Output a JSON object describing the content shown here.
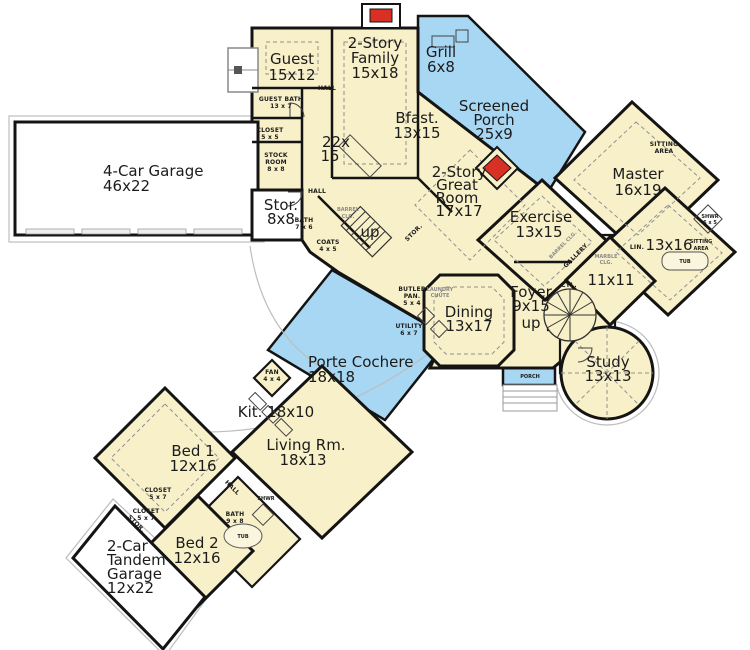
{
  "plan": {
    "colors": {
      "floor": "#f7f0c9",
      "outdoor_blue": "#a8d7f3",
      "fireplace_red": "#d93025",
      "wall": "#141414",
      "garage_white": "#ffffff"
    },
    "rooms": {
      "guest": {
        "name": "Guest",
        "dims": "15x12"
      },
      "family": {
        "l1": "2-Story",
        "l2": "Family",
        "dims": "15x18"
      },
      "grill": {
        "name": "Grill",
        "dims": "6x8"
      },
      "screened_porch": {
        "l1": "Screened",
        "l2": "Porch",
        "dims": "25x9"
      },
      "master": {
        "name": "Master",
        "dims": "16x19"
      },
      "bfast": {
        "name": "Bfast.",
        "dims": "13x15"
      },
      "kitchen22": {
        "l1": "22x",
        "l2": "15"
      },
      "great": {
        "l1": "2-Story",
        "l2": "Great",
        "l3": "Room",
        "dims": "17x17"
      },
      "exercise": {
        "name": "Exercise",
        "dims": "13x15"
      },
      "garage4": {
        "name": "4-Car Garage",
        "dims": "46x22"
      },
      "stor": {
        "name": "Stor.",
        "dims": "8x8"
      },
      "mbath": {
        "dims": "13x16"
      },
      "flex11": {
        "dims": "11x11"
      },
      "foyer": {
        "name": "Foyer",
        "dims": "9x15"
      },
      "dining": {
        "name": "Dining",
        "dims": "13x17"
      },
      "study": {
        "name": "Study",
        "dims": "13x13"
      },
      "porte": {
        "name": "Porte Cochere",
        "dims": "18x18"
      },
      "kit": {
        "name": "Kit. 18x10"
      },
      "living": {
        "name": "Living Rm.",
        "dims": "18x13"
      },
      "bed1": {
        "name": "Bed 1",
        "dims": "12x16"
      },
      "bed2": {
        "name": "Bed 2",
        "dims": "12x16"
      },
      "garage2": {
        "l1": "2-Car",
        "l2": "Tandem",
        "l3": "Garage",
        "dims": "12x22"
      }
    },
    "annotations": {
      "up_back": "up",
      "up_foyer": "up"
    },
    "small": {
      "guest_bath_1": "GUEST BATH",
      "guest_bath_2": "13 x 7",
      "closet55_1": "CLOSET",
      "closet55_2": "5 x 5",
      "stock_1": "STOCK",
      "stock_2": "ROOM",
      "stock_3": "8 x 8",
      "hall_top": "HALL",
      "hall_mid": "HALL",
      "bath76_1": "BATH",
      "bath76_2": "7 x 6",
      "coats_1": "COATS",
      "coats_2": "4 x 5",
      "barrel_1": "BARREL",
      "barrel_2": "CLG.",
      "stor_rot": "STOR.",
      "butler_1": "BUTLER",
      "butler_2": "PAN.",
      "butler_3": "5 x 4",
      "laundry_1": "LAUNDRY",
      "laundry_2": "CHUTE",
      "utility_1": "UTILITY",
      "utility_2": "6 x 7",
      "fan_1": "FAN",
      "fan_2": "4 x 4",
      "gallery": "GALLERY",
      "barrel2": "BARREL CLG.",
      "marble_1": "MARBLE",
      "marble_2": "CLG.",
      "lin": "LIN.",
      "cyl": "CYL.",
      "sitting1_1": "SITTING",
      "sitting1_2": "AREA",
      "sitting2_1": "SITTING",
      "sitting2_2": "AREA",
      "shwr65_1": "SHWR",
      "shwr65_2": "6 x 5",
      "tub1": "TUB",
      "tub2": "TUB",
      "bath98_1": "BATH",
      "bath98_2": "9 x 8",
      "shwr": "SHWR",
      "closet57a_1": "CLOSET",
      "closet57a_2": "5 x 7",
      "closet57b_1": "CLOSET",
      "closet57b_2": "5 x 7",
      "hall_low": "HALL",
      "stor_low": "STOR.",
      "porch": "PORCH"
    }
  }
}
